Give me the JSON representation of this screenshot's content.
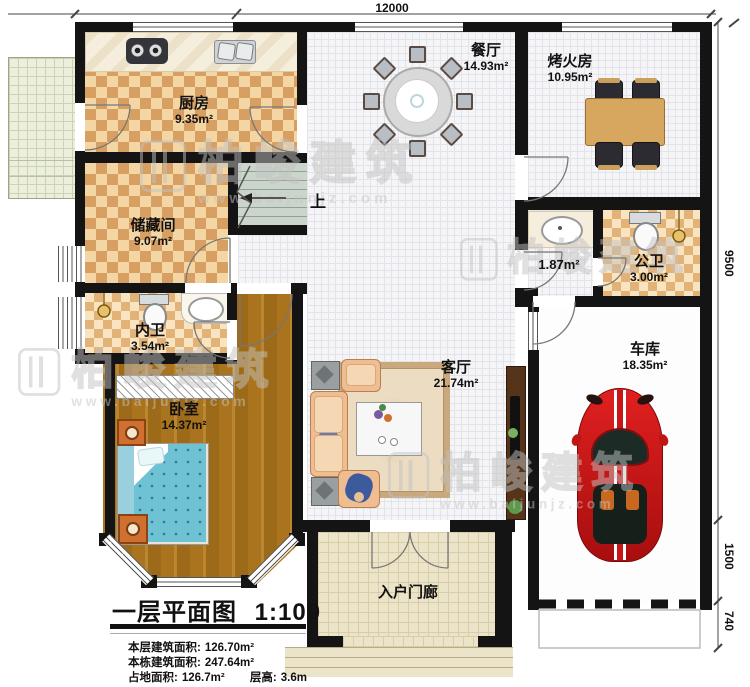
{
  "plan": {
    "dim_top": "12000",
    "dim_right": [
      "9500",
      "1500",
      "740"
    ],
    "stairs_up": "上",
    "rooms": [
      {
        "id": "kitchen",
        "name": "厨房",
        "area": "9.35m²"
      },
      {
        "id": "dining",
        "name": "餐厅",
        "area": "14.93m²"
      },
      {
        "id": "fire-lounge",
        "name": "烤火房",
        "area": "10.95m²"
      },
      {
        "id": "storage",
        "name": "储藏间",
        "area": "9.07m²"
      },
      {
        "id": "lobby",
        "name": "",
        "area": "1.87m²"
      },
      {
        "id": "public-bath",
        "name": "公卫",
        "area": "3.00m²"
      },
      {
        "id": "inner-bath",
        "name": "内卫",
        "area": "3.54m²"
      },
      {
        "id": "bedroom",
        "name": "卧室",
        "area": "14.37m²"
      },
      {
        "id": "living",
        "name": "客厅",
        "area": "21.74m²"
      },
      {
        "id": "garage",
        "name": "车库",
        "area": "18.35m²"
      },
      {
        "id": "porch",
        "name": "入户门廊",
        "area": ""
      }
    ]
  },
  "title_block": {
    "title": "一层平面图",
    "scale": "1:100",
    "stats": [
      {
        "label": "本层建筑面积:",
        "value": "126.70m²"
      },
      {
        "label": "本栋建筑面积:",
        "value": "247.64m²"
      },
      {
        "label": "占地面积:",
        "value": "126.7m²"
      },
      {
        "label": "层高:",
        "value": "3.6m"
      }
    ]
  },
  "watermark": {
    "text": "柏峻建筑",
    "url": "www.baijunjz.com"
  },
  "colors": {
    "wall": "#141414",
    "car_red": "#cf1717",
    "checker_dark": "#d89f63",
    "checker_light": "#f3d6a4"
  }
}
